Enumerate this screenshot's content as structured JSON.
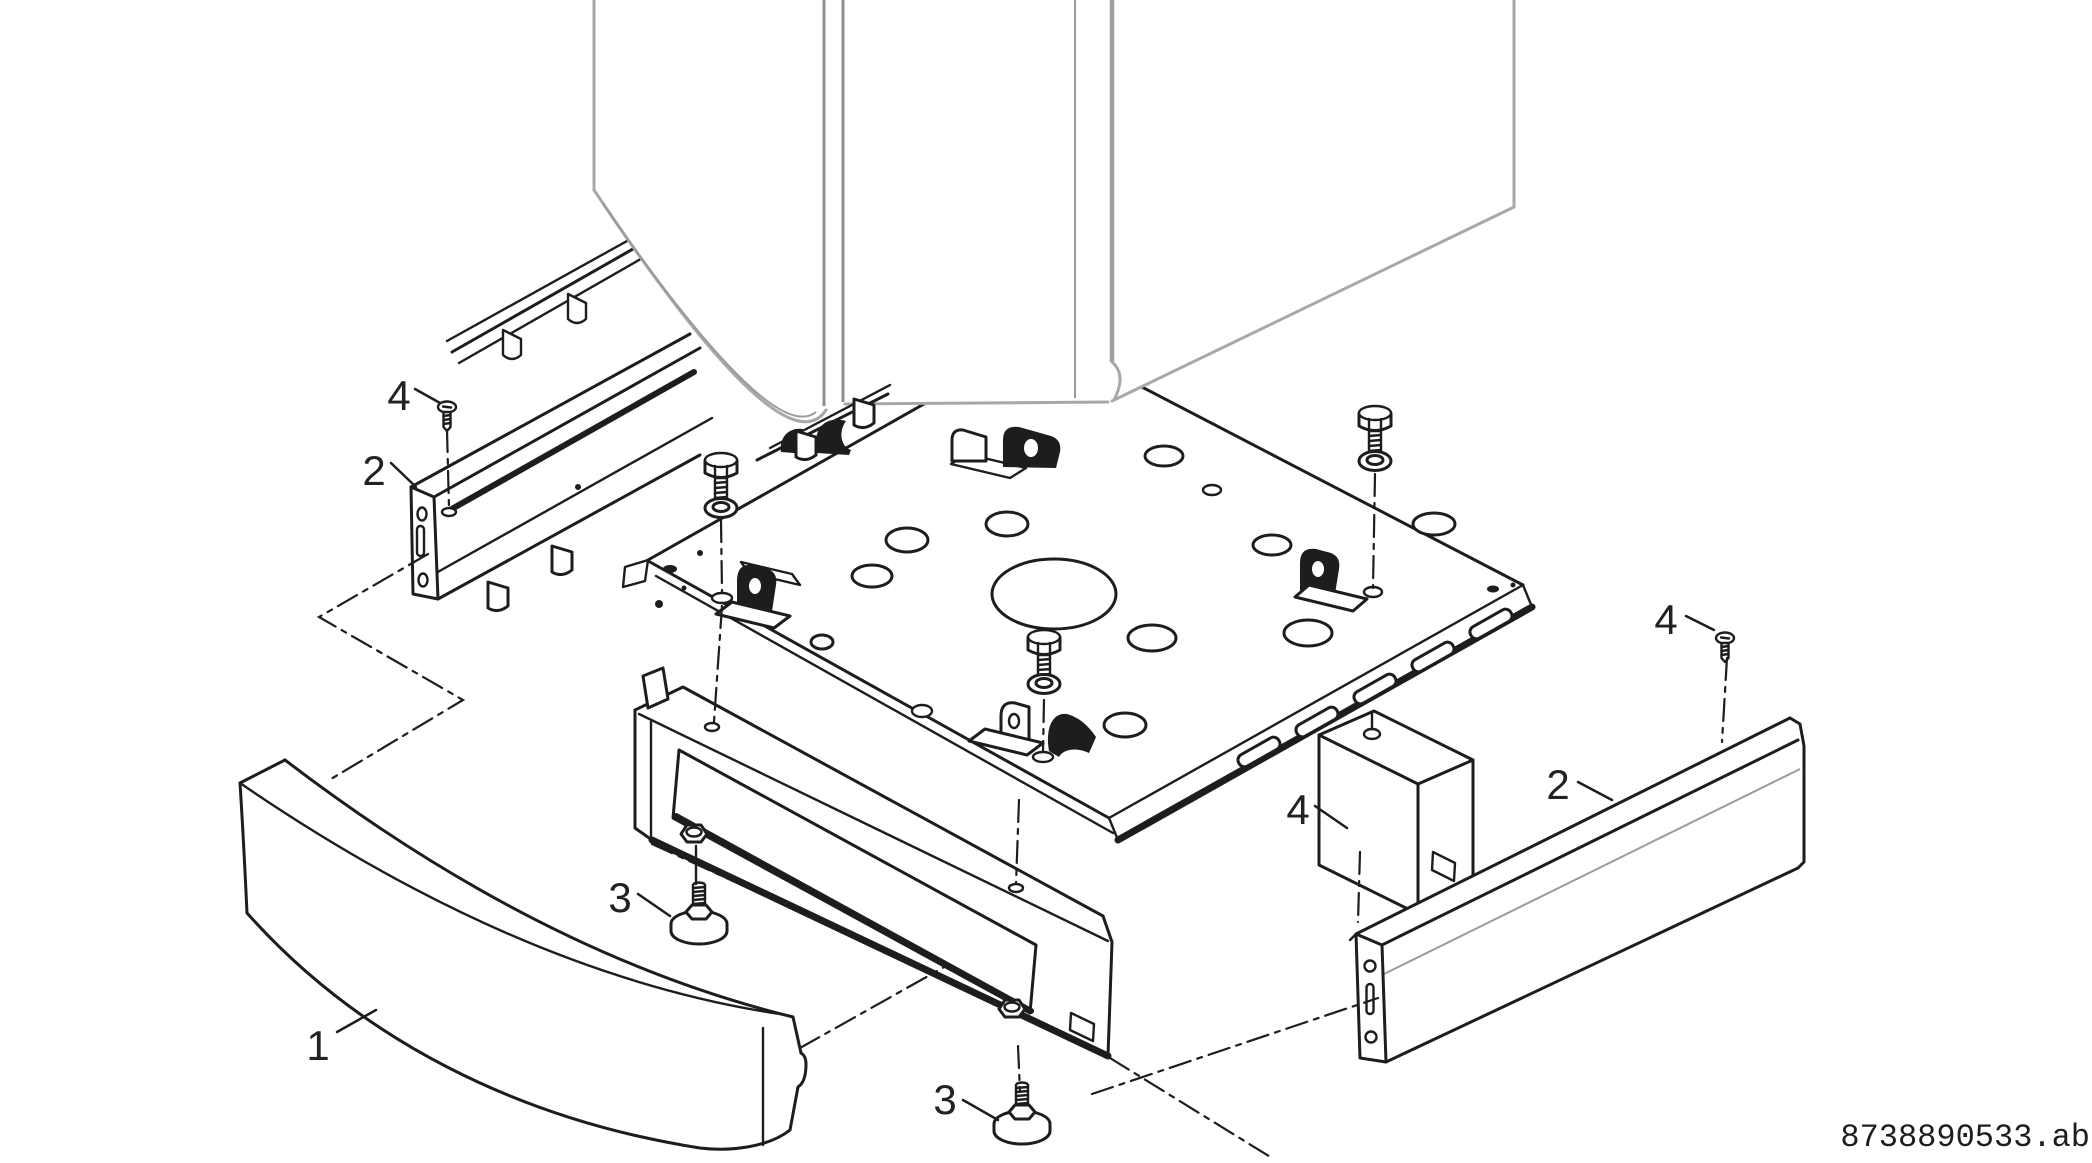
{
  "figure": {
    "type": "exploded-parts-diagram",
    "description": "Exploded view of appliance pedestal base assembly",
    "reference_code": "8738890533.ab",
    "callouts": [
      {
        "id": "callout-4-upper-left",
        "label": "4",
        "part": "countersunk-screw"
      },
      {
        "id": "callout-2-left",
        "label": "2",
        "part": "side-rail"
      },
      {
        "id": "callout-1-front-panel",
        "label": "1",
        "part": "curved-front-panel"
      },
      {
        "id": "callout-3-left-foot",
        "label": "3",
        "part": "leveling-foot"
      },
      {
        "id": "callout-3-bottom-foot",
        "label": "3",
        "part": "leveling-foot"
      },
      {
        "id": "callout-4-middle",
        "label": "4",
        "part": "countersunk-screw"
      },
      {
        "id": "callout-2-right",
        "label": "2",
        "part": "side-rail"
      },
      {
        "id": "callout-4-right",
        "label": "4",
        "part": "countersunk-screw"
      }
    ],
    "colors": {
      "line": "#1d1d1b",
      "appliance_outline": "#a8a8a8",
      "background": "#ffffff"
    }
  }
}
